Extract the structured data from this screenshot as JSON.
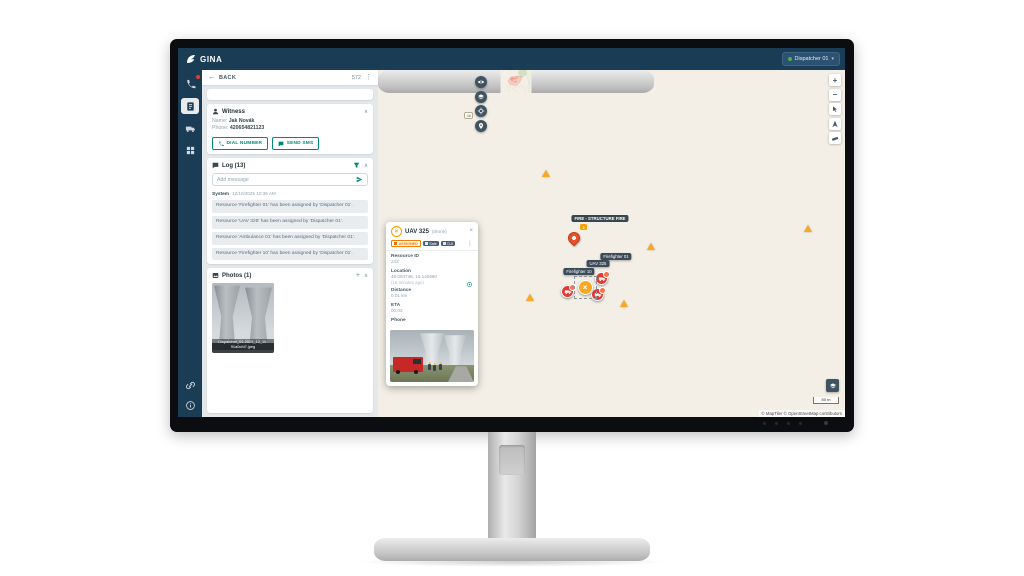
{
  "brand": "GINA",
  "top_bar": {
    "user_label": "Dispatcher 01"
  },
  "panel": {
    "back_label": "BACK",
    "counter": "572",
    "witness": {
      "title": "Witness",
      "name_label": "Name:",
      "name_value": "Jak Novák",
      "phone_label": "Phone:",
      "phone_value": "420654821123",
      "dial_label": "DIAL NUMBER",
      "sms_label": "SEND SMS"
    },
    "log": {
      "title": "Log (13)",
      "placeholder": "Add message",
      "system_label": "System",
      "system_time": "12/10/2025 10:39 AM",
      "messages": [
        "Resource 'Firefighter 01' has been assigned by 'Dispatcher 01'.",
        "Resource 'UAV 325' has been assigned by 'Dispatcher 01'.",
        "Resource 'Ambulance 01' has been assigned by 'Dispatcher 01'.",
        "Resource 'Firefighter 10' has been assigned by 'Dispatcher 01'."
      ]
    },
    "photos": {
      "title": "Photos (1)",
      "caption_line1": "Dispatcher_01-2025_12_10-",
      "caption_line2": "91a0cfd7.jpeg"
    }
  },
  "popup": {
    "title": "UAV 325",
    "subtitle": "(drone)",
    "badges": {
      "status": "ASSIGNED",
      "tag1": "Safe",
      "tag2": "DJI"
    },
    "resource_id_label": "Resource ID",
    "resource_id": "243",
    "location_label": "Location",
    "location_value": "49.084746, 16.140660",
    "location_age": "(16 minutes ago)",
    "distance_label": "Distance",
    "distance_value": "0.01 km",
    "eta_label": "ETA",
    "eta_value": "00:02",
    "phone_label": "Phone"
  },
  "map": {
    "incident_label": "FIRE - STRUCTURE FIRE",
    "incident_count": "2",
    "road_ref": "46",
    "resource_labels": [
      "Firefighter 01",
      "UAV 325",
      "Firefighter 10"
    ],
    "scale_label": "50 m",
    "attribution": "© MapTiler © OpenStreetMap contributors"
  },
  "colors": {
    "navy": "#1b3c55",
    "teal": "#00897b",
    "amber": "#f9a825",
    "alert_red": "#e53935",
    "fire_zone": "#ef5350"
  }
}
